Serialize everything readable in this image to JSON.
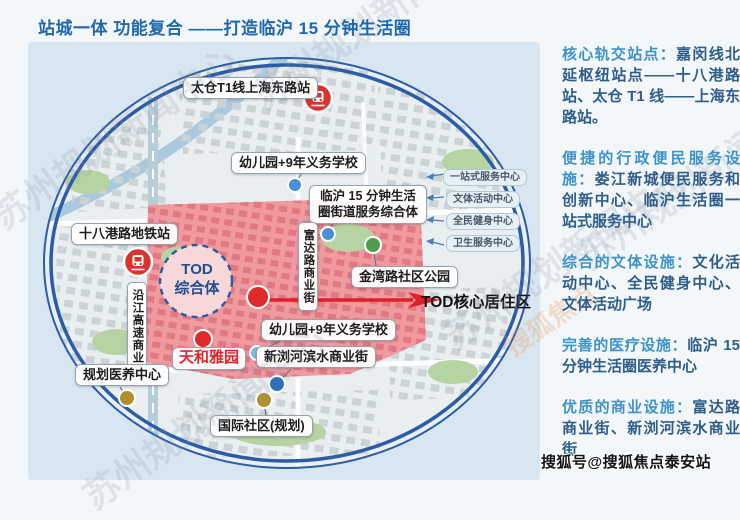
{
  "title": "站城一体 功能复合 ——打造临沪 15 分钟生活圈",
  "map": {
    "labels": {
      "taicang_station": "太仓T1线上海东路站",
      "kindergarten_school_top": "幼儿园+9年义务学校",
      "linhu_hub_line1": "临沪 15 分钟生活",
      "linhu_hub_line2": "圈街道服务综合体",
      "shibagang_station": "十八港路地铁站",
      "yanjiang_corridor": "沿江高速商业圈",
      "fuda_street": "富达路商业街",
      "jinwan_park": "金湾路社区公园",
      "tod_line1": "TOD",
      "tod_line2": "综合体",
      "tod_core_area": "TOD核心居住区",
      "kindergarten_school_bottom": "幼儿园+9年义务学校",
      "tianhe_garden": "天和雅园",
      "xinliu_street": "新浏河滨水商业街",
      "medical_center": "规划医养中心",
      "intl_community": "国际社区(规划)"
    },
    "service_pills": [
      "一站式服务中心",
      "文体活动中心",
      "全民健身中心",
      "卫生服务中心"
    ]
  },
  "info_panel": {
    "sections": [
      {
        "label": "核心轨交站点：",
        "text": "嘉闵线北延枢纽站点——十八港路站、太仓 T1 线——上海东路站。"
      },
      {
        "label": "便捷的行政便民服务设施：",
        "text": "娄江新城便民服务和创新中心、临沪生活圈一站式服务中心"
      },
      {
        "label": "综合的文体设施：",
        "text": "文化活动中心、全民健身中心、文体活动广场"
      },
      {
        "label": "完善的医疗设施：",
        "text": "临沪 15 分钟生活圈医养中心"
      },
      {
        "label": "优质的商业设施：",
        "text": "富达路商业街、新浏河滨水商业街"
      }
    ]
  },
  "watermarks": {
    "diagonal": "苏州规划新闻中心",
    "sohu_brand": "搜狐焦点",
    "attribution": "搜狐号@搜狐焦点泰安站"
  },
  "colors": {
    "title": "#1e68ad",
    "section_heading": "#3e93c9",
    "section_body": "#2f5d89",
    "zone_pink": "#f0999f",
    "ring_blue": "#2a5ca7",
    "arrow_red": "#e31e24"
  }
}
